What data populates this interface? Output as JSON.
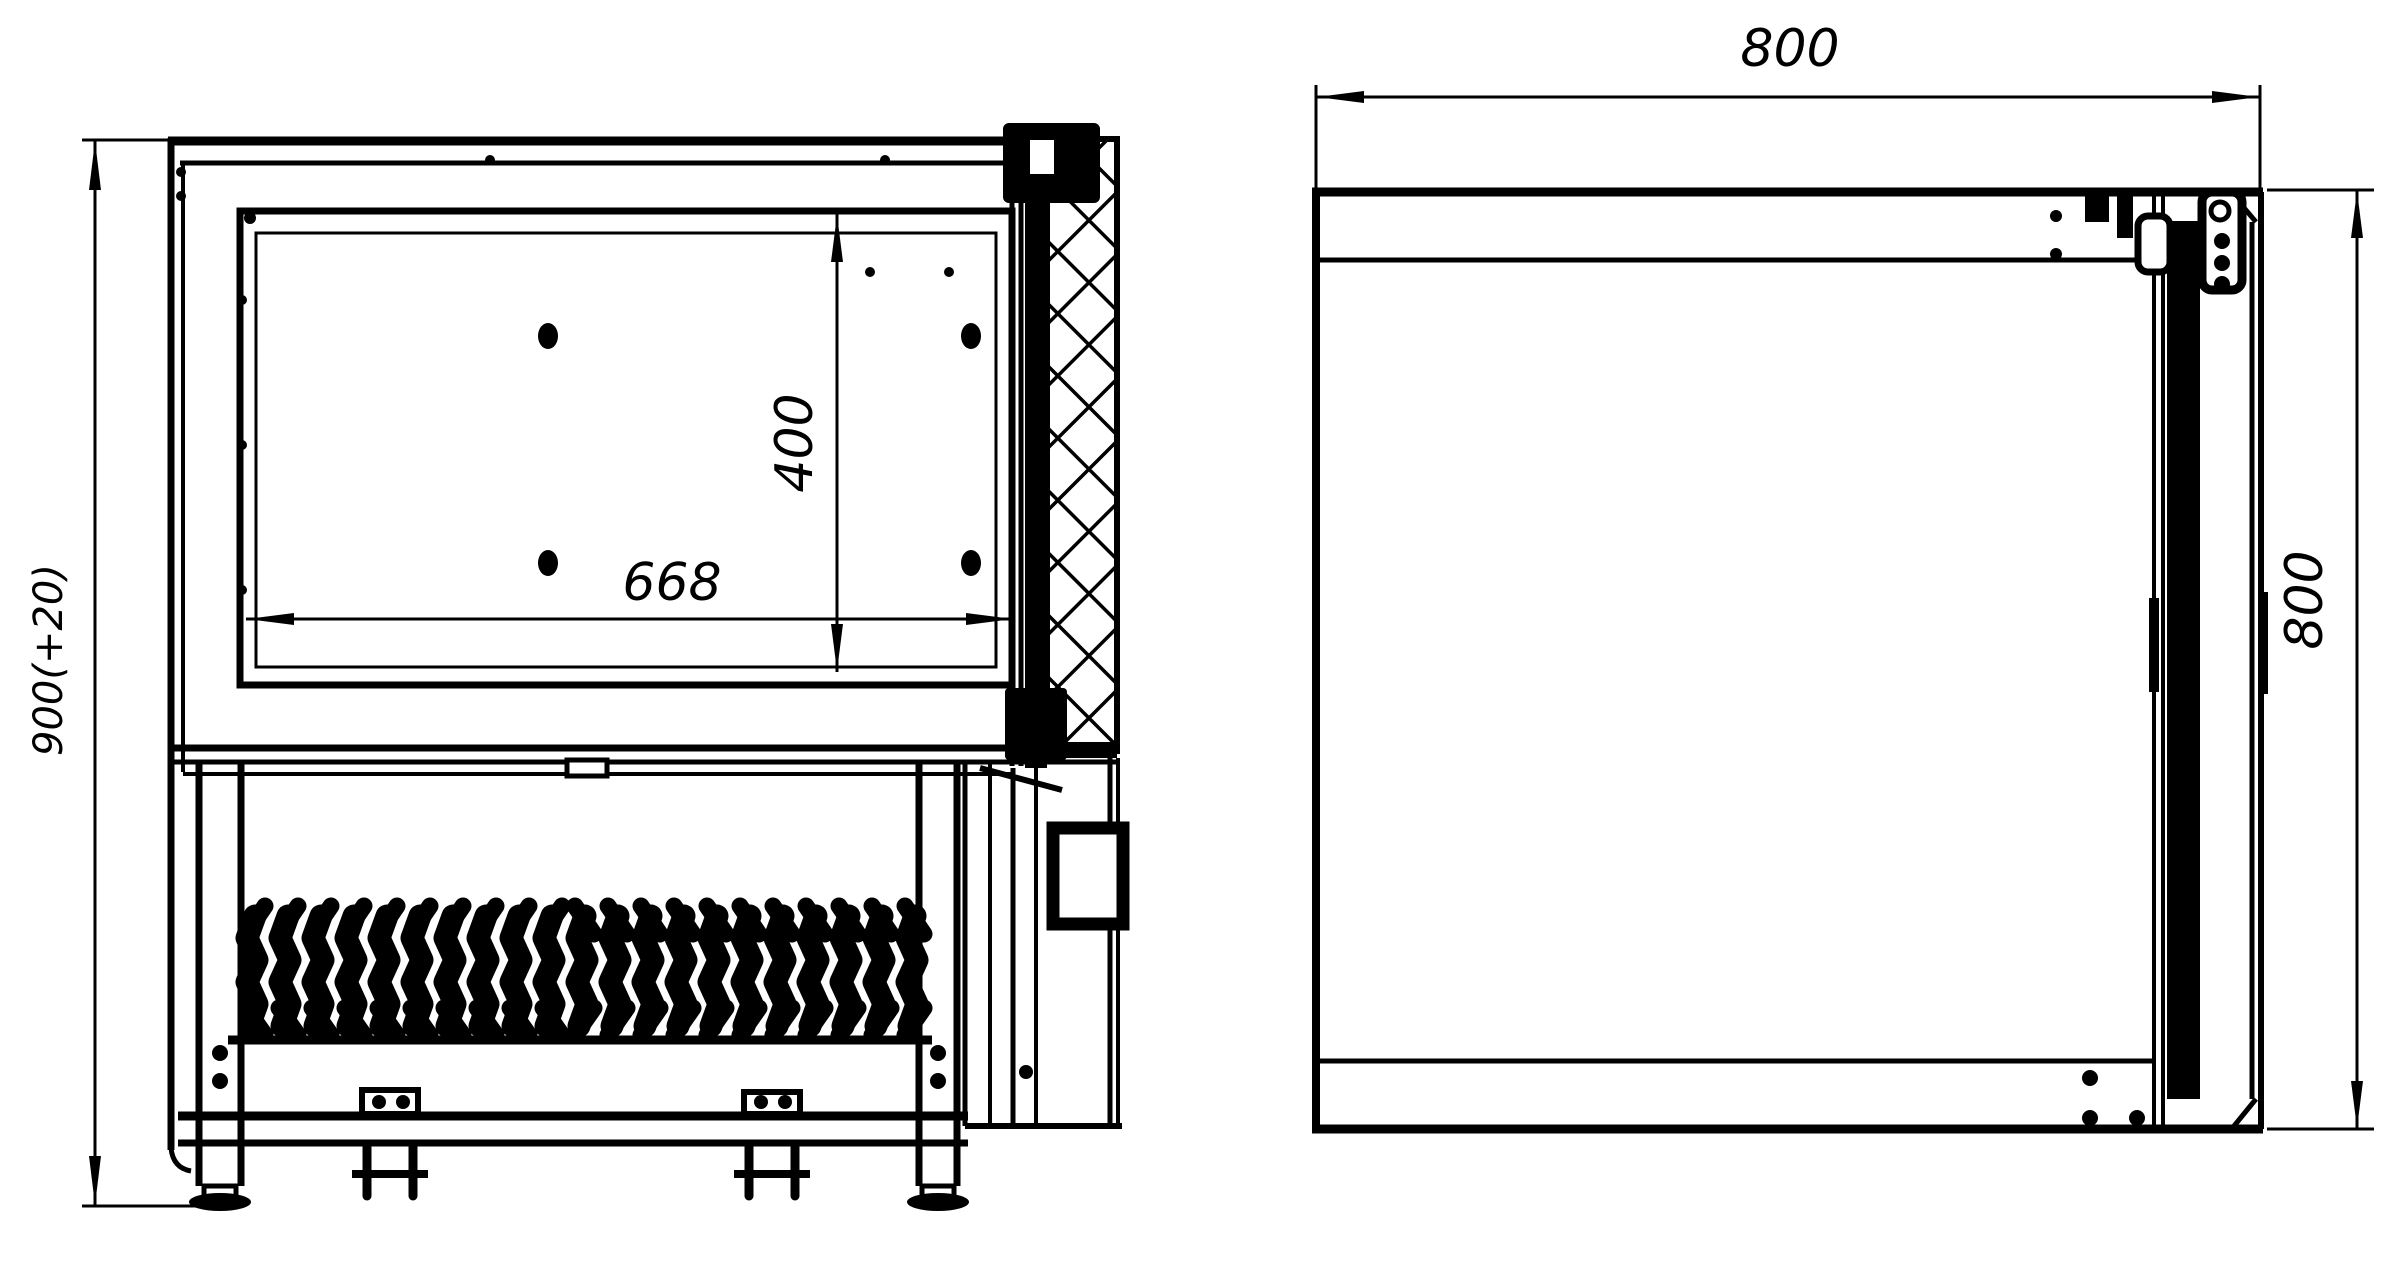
{
  "drawing": {
    "colors": {
      "background": "#ffffff",
      "line": "#000000"
    },
    "views": {
      "side_section": {
        "dimensions": {
          "overall_height": "900(+20)",
          "chamber_width": "668",
          "chamber_depth": "400"
        }
      },
      "plan": {
        "dimensions": {
          "overall_width": "800",
          "overall_depth": "800"
        }
      }
    }
  }
}
